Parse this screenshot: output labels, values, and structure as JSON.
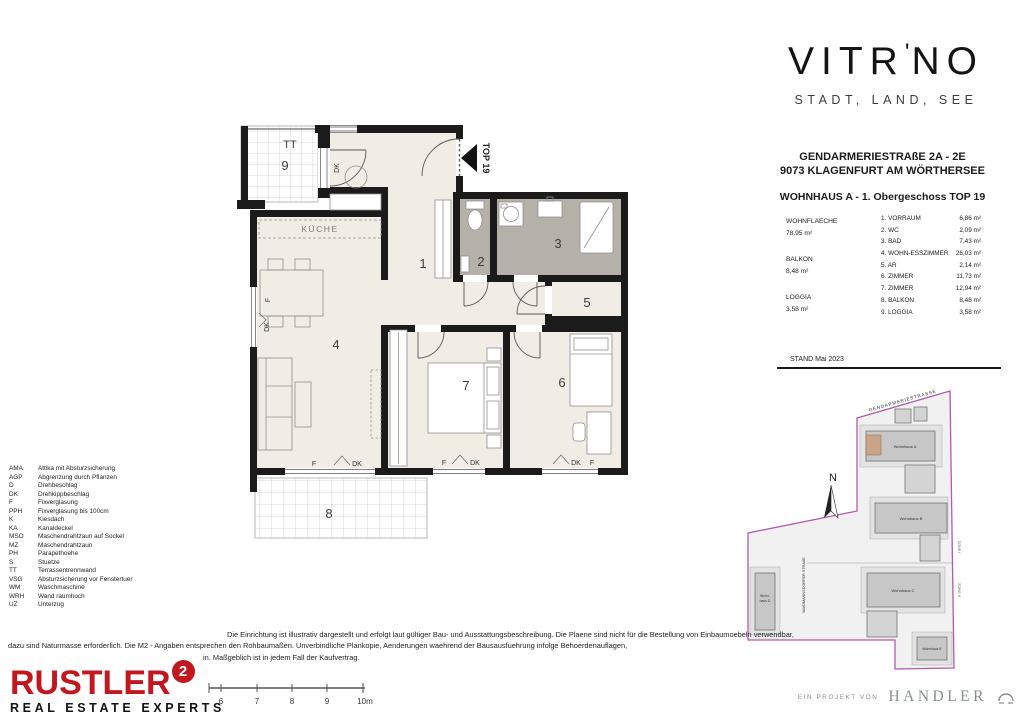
{
  "brand": {
    "pre": "VITR",
    "mark": "'",
    "post": "NO",
    "tagline": "STADT, LAND, SEE"
  },
  "header": {
    "address_line1": "GENDARMERIESTRAßE 2A - 2E",
    "address_line2": "9073 KLAGENFURT AM WÖRTHERSEE",
    "unit_title": "WOHNHAUS A - 1. Obergeschoss TOP 19",
    "stand": "STAND Mai 2023"
  },
  "summary": [
    {
      "label": "WOHNFLAECHE",
      "value": "78,95 m²"
    },
    {
      "label": "BALKON",
      "value": "8,48 m²"
    },
    {
      "label": "LOGGIA",
      "value": "3,58 m²"
    }
  ],
  "room_list": [
    {
      "name": "1. VORRAUM",
      "area": "6,86 m²"
    },
    {
      "name": "2. WC",
      "area": "2,09 m²"
    },
    {
      "name": "3. BAD",
      "area": "7,43 m²"
    },
    {
      "name": "4. WOHN-ESSZIMMER",
      "area": "26,03 m²"
    },
    {
      "name": "5. AR",
      "area": "2,14 m²"
    },
    {
      "name": "6. ZIMMER",
      "area": "11,73 m²"
    },
    {
      "name": "7. ZIMMER",
      "area": "12,94 m²"
    },
    {
      "name": "8. BALKON",
      "area": "8,48 m²"
    },
    {
      "name": "9. LOGGIA",
      "area": "3,58 m²"
    }
  ],
  "floorplan": {
    "top_label": "TOP 19",
    "kueche": "KÜCHE",
    "tt": "TT",
    "room1": "1",
    "room2": "2",
    "room3": "3",
    "room4": "4",
    "room5": "5",
    "room6": "6",
    "room7": "7",
    "room8": "8",
    "room9": "9",
    "f": "F",
    "dk": "DK"
  },
  "legend": [
    {
      "abbr": "AMA",
      "desc": "Attika mit Absturzsicherung"
    },
    {
      "abbr": "AGP",
      "desc": "Abgrenzung durch Pflanzen"
    },
    {
      "abbr": "D",
      "desc": "Drehbeschlag"
    },
    {
      "abbr": "DK",
      "desc": "Drehkippbeschlag"
    },
    {
      "abbr": "F",
      "desc": "Fixverglasung"
    },
    {
      "abbr": "PPH",
      "desc": "Fixverglasung bis 100cm"
    },
    {
      "abbr": "K",
      "desc": "Kiesdach"
    },
    {
      "abbr": "KA",
      "desc": "Kanaldeckel"
    },
    {
      "abbr": "MSO",
      "desc": "Maschendrahtzaun auf Sockel"
    },
    {
      "abbr": "MZ",
      "desc": "Maschendrahtzaun"
    },
    {
      "abbr": "PH",
      "desc": "Parapethoehe"
    },
    {
      "abbr": "S",
      "desc": "Stuetze"
    },
    {
      "abbr": "TT",
      "desc": "Terrassentrennwand"
    },
    {
      "abbr": "VSG",
      "desc": "Absturzsicherung vor Fenstertuer"
    },
    {
      "abbr": "WM",
      "desc": "Waschmaschine"
    },
    {
      "abbr": "WRH",
      "desc": "Wand raumhoch"
    },
    {
      "abbr": "UZ",
      "desc": "Unterzug"
    }
  ],
  "siteplan": {
    "street_top": "GENDARMERIESTRASSE",
    "street_left": "WAIDMANNSDORFER STRAßE",
    "zone1": "ZONE I",
    "zone2": "ZONE II",
    "north": "N",
    "house_a": "Wohnhaus A",
    "house_b": "Wohnhaus B",
    "house_c": "Wohnhaus C",
    "house_d1": "Wohn-",
    "house_d2": "haus D",
    "house_e": "Wohnhaus E"
  },
  "disclaimer": {
    "line1": "Die Einrichtung ist illustrativ dargestellt und erfolgt laut gültiger Bau- und Ausstattungsbeschreibung. Die Plaene sind nicht für die Bestellung von Einbaumoebeln verwendbar,",
    "line2": "dazu sind Naturmasse erforderlich. Die M2 - Angaben entsprechen den Rohbaumaßen. Unverbindliche Plankopie, Aenderungen waehrend der Bausausfuehrung infolge Behoerdenauflagen,",
    "line3": "in. Maßgeblich ist in jedem Fall der Kaufvertrag."
  },
  "footer": {
    "rustler_name": "RUSTLER",
    "rustler_sup": "2",
    "rustler_tagline": "REAL ESTATE EXPERTS",
    "scale_ticks": [
      "6",
      "7",
      "8",
      "9",
      "10m"
    ],
    "handler_prefix": "EIN PROJEKT VON",
    "handler_name": "HANDLER"
  },
  "colors": {
    "accent_red": "#c2171f",
    "plan_floor": "#f1ece4",
    "bath_floor": "#b6b1a8",
    "wall": "#1b1b1b",
    "site_boundary": "#b05ab0",
    "highlight_unit": "#c8a488"
  }
}
